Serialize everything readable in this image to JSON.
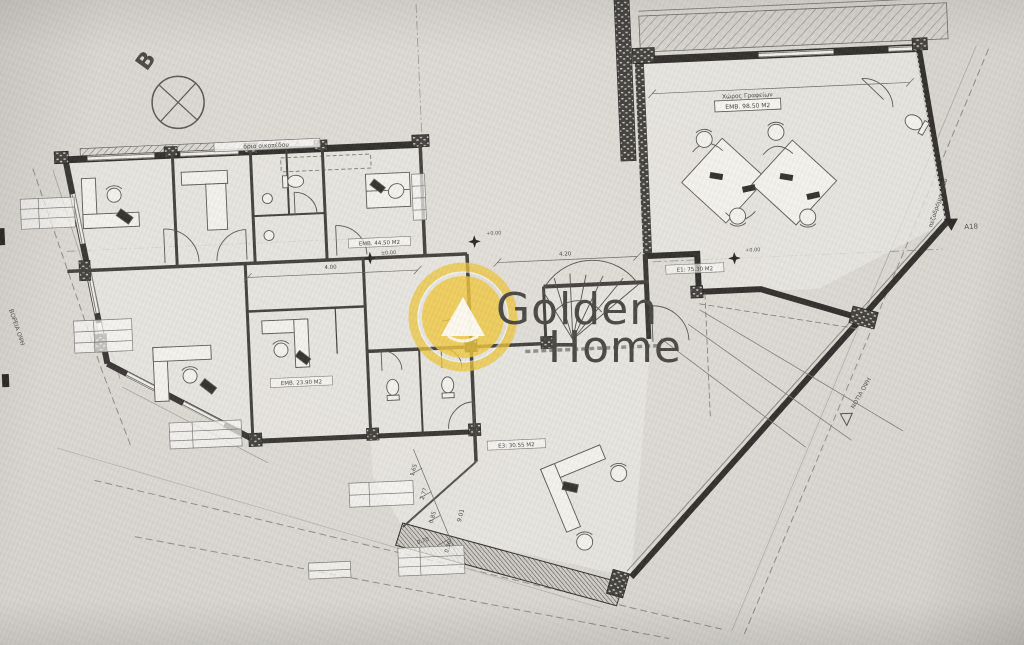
{
  "watermark": {
    "word1": "Golden",
    "word2": "Home"
  },
  "plan": {
    "north_label": "B",
    "boundary_label": "όριο οικοπέδου",
    "office": {
      "title": "Χώρος Γραφείων",
      "area": "ΕΜΒ. 98.50 Μ2"
    },
    "areas": {
      "e1": "Ε1: 75.30 Μ2",
      "hall": "ΕΜΒ. 44.50 Μ2",
      "room_low": "ΕΜΒ. 23.90 Μ2",
      "e3": "Ε3: 30.55 Μ2"
    },
    "levels": {
      "a": "+0.00",
      "b": "+0.00",
      "c": "±0.00"
    },
    "markers": {
      "a18": "A18",
      "south": "ΝΟΤΙΑ ΟΨΗ",
      "west": "ΒΟΡΕΙΑ ΟΨΗ",
      "street": "πεζοδρόμιο οδού"
    },
    "dims": {
      "d1": "4.00",
      "d2": "4.20",
      "d3": "1.65",
      "d4": "2.77",
      "d5": "0.85",
      "d6": "9.01",
      "d7": "0.70",
      "d8": "0.36"
    }
  }
}
